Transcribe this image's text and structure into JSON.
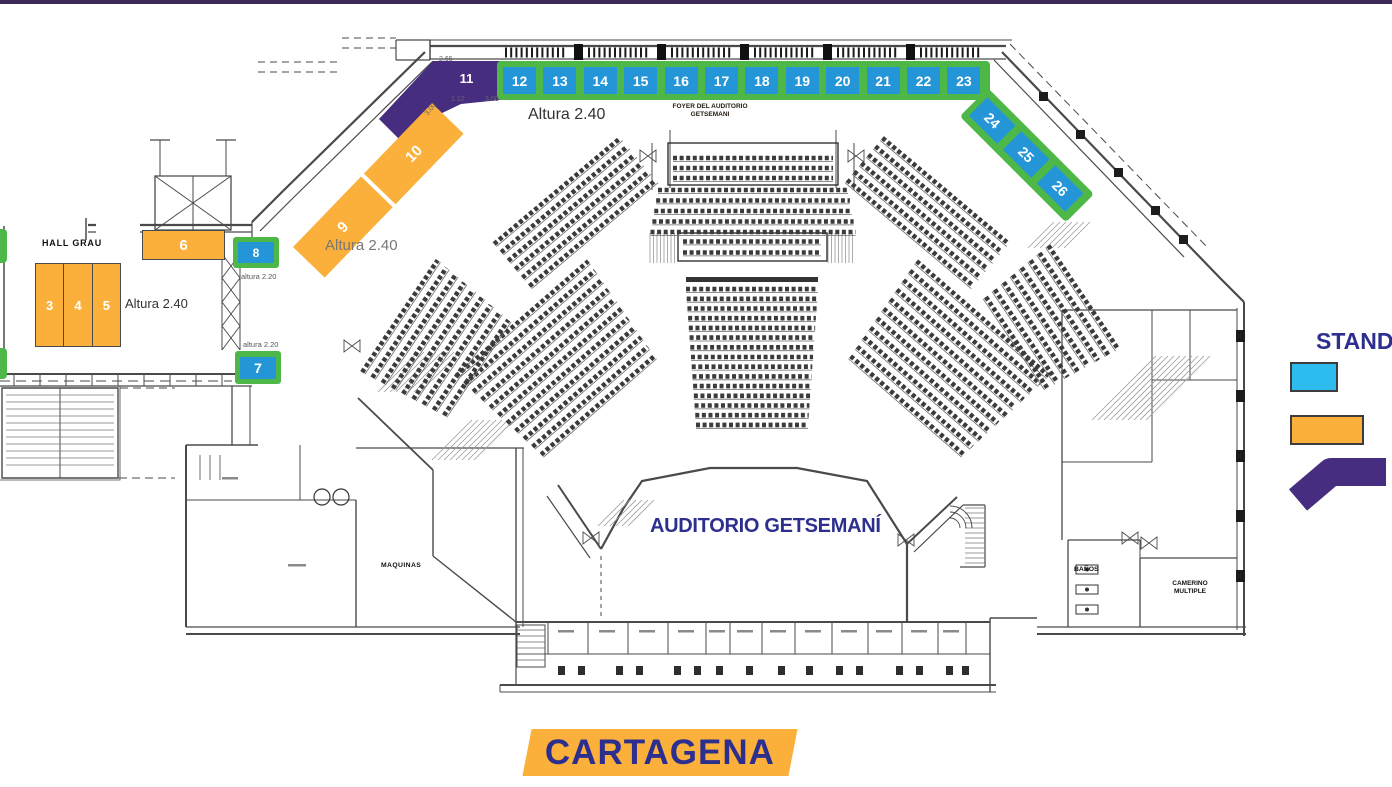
{
  "colors": {
    "top_bar": "#3C2A56",
    "green_frame": "#4DB748",
    "stand_blue": "#2496D8",
    "legend_blue": "#2EBCEF",
    "orange": "#FBB03B",
    "purple": "#462D7F",
    "navy_text": "#2D2F8F",
    "line_work": "#4a4a4a"
  },
  "plan_labels": {
    "auditorium": "AUDITORIO GETSEMANÍ",
    "foyer_line1": "FOYER DEL AUDITORIO",
    "foyer_line2": "GETSEMANI",
    "hall_grau": "HALL GRAU",
    "maquinas": "MAQUINAS",
    "banos": "BAÑOS",
    "camerino_line1": "CAMERINO",
    "camerino_line2": "MULTIPLE",
    "altura_240_foyer": "Altura 2.40",
    "altura_240_ramp": "Altura 2.40",
    "altura_240_hall": "Altura 2.40",
    "altura_220_top": "altura 2.20",
    "altura_220_bottom": "altura 2.20",
    "dim_265": "2.65",
    "dim_112": "1.12",
    "dim_300_a": "3.00",
    "dim_300_b": "3.00"
  },
  "city_banner": {
    "label": "CARTAGENA"
  },
  "legend": {
    "title": "STAND",
    "items": [
      {
        "name": "blue-stand-type",
        "color": "#2EBCEF"
      },
      {
        "name": "orange-stand-type",
        "color": "#FBB03B"
      },
      {
        "name": "purple-stand-type",
        "color": "#462D7F"
      }
    ]
  },
  "stands": {
    "top_row": [
      "12",
      "13",
      "14",
      "15",
      "16",
      "17",
      "18",
      "19",
      "20",
      "21",
      "22",
      "23"
    ],
    "diagonal_right": [
      "24",
      "25",
      "26"
    ],
    "hall_block": [
      "3",
      "4",
      "5"
    ],
    "ramp_band": [
      "9",
      "10"
    ],
    "singles": {
      "s6": "6",
      "s7": "7",
      "s8": "8",
      "s11": "11"
    }
  }
}
